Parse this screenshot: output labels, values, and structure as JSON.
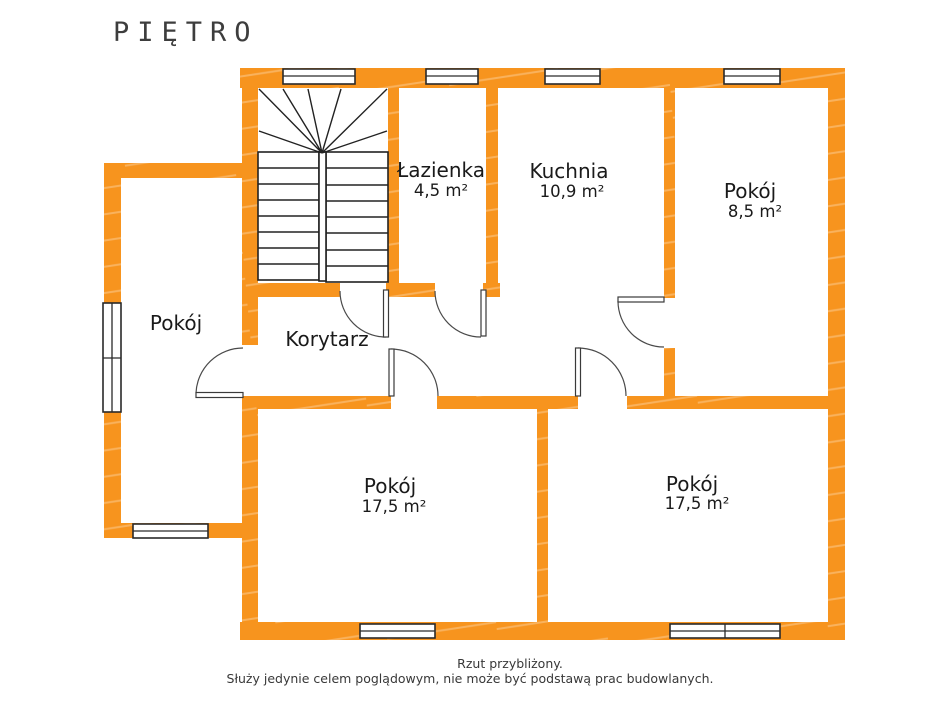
{
  "title": "PIĘTRO",
  "rooms": {
    "bathroom": {
      "name": "Łazienka",
      "area": "4,5 m²"
    },
    "kitchen": {
      "name": "Kuchnia",
      "area": "10,9 m²"
    },
    "small_room": {
      "name": "Pokój",
      "area": "8,5 m²"
    },
    "left_room": {
      "name": "Pokój"
    },
    "corridor": {
      "name": "Korytarz"
    },
    "bottom_left_room": {
      "name": "Pokój",
      "area": "17,5 m²"
    },
    "bottom_right_room": {
      "name": "Pokój",
      "area": "17,5 m²"
    }
  },
  "footer": {
    "line1": "Rzut przybliżony.",
    "line2": "Służy jedynie celem poglądowym, nie może być podstawą prac budowlanych."
  },
  "colors": {
    "wall_orange": "#F7941E",
    "line_dark": "#2a2a2a",
    "text_black": "#1a1a1a",
    "footer_gray": "#383838"
  }
}
